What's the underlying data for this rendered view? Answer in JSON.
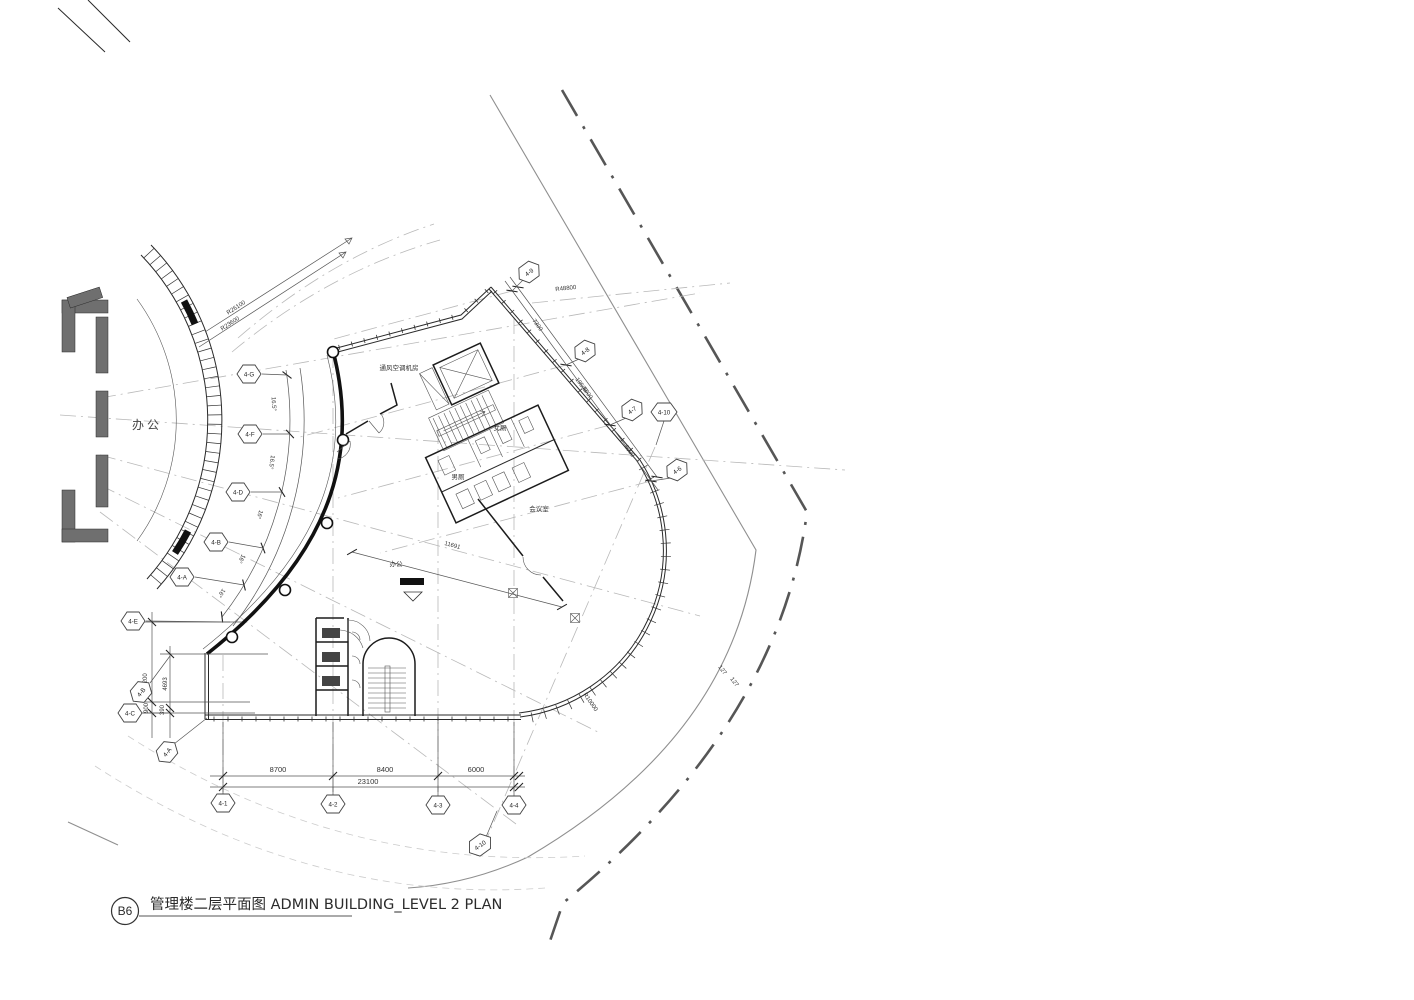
{
  "title_block": {
    "no": "B6",
    "title": "管理楼二层平面图 ADMIN BUILDING_LEVEL 2 PLAN"
  },
  "rooms": {
    "office": "办公",
    "office_small": "办公",
    "mech": "通风空调机房",
    "women_wc": "女厕",
    "men_wc": "男厕",
    "meeting": "会议室"
  },
  "grids": [
    "4-G",
    "4-F",
    "4-D",
    "4-B",
    "4-A",
    "4-E",
    "4-B",
    "4-C",
    "4-A",
    "4-1",
    "4-2",
    "4-3",
    "4-4",
    "4-9",
    "4-8",
    "4-7",
    "4-10",
    "4-6",
    "4-10"
  ],
  "dims": {
    "bottom": [
      "8700",
      "8400",
      "6000"
    ],
    "bottom_total": "23100",
    "left": [
      "7200",
      "4693",
      "900",
      "390"
    ],
    "right": [
      "7300",
      "6000",
      "6000"
    ],
    "right_total": "19500",
    "interior": "11691",
    "angles": [
      "16.5°",
      "16.5°",
      "16°",
      "16°",
      "16°"
    ],
    "road_offsets": [
      "127",
      "127"
    ],
    "corner_radius": "R10000"
  },
  "radii": {
    "r1": "R26100",
    "r2": "R23600",
    "r3": "R48800"
  }
}
